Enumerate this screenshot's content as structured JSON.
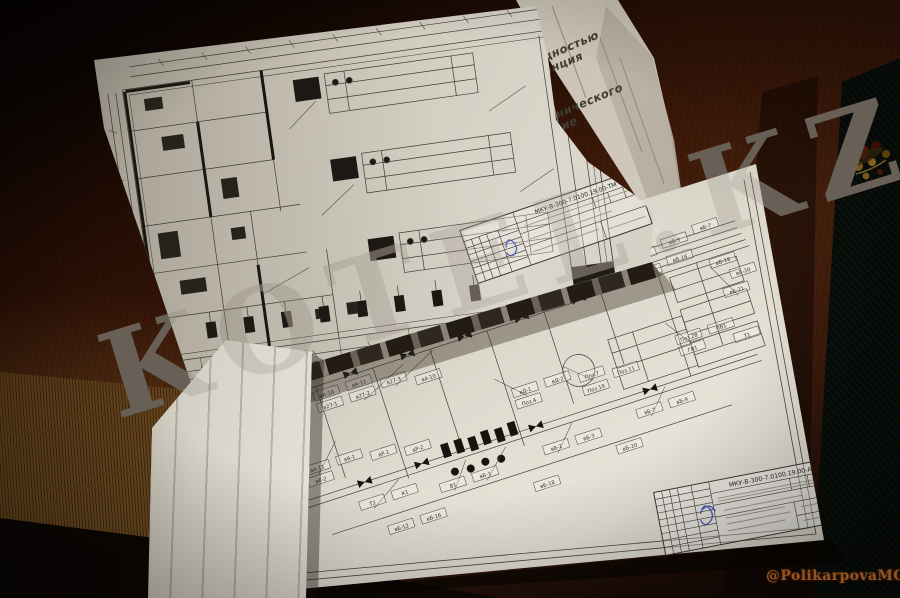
{
  "photo": {
    "watermark_text": "KOTEL.KZ",
    "attribution": "@PolikarpovaMG2020"
  },
  "album": {
    "page_edge_labels": [
      {
        "line1": "щностью",
        "line2": "танция"
      },
      {
        "line1": "нического",
        "line2": "ние"
      }
    ],
    "title_block_code": "МКУ-В-300-7.0100.19.00-ТМ"
  },
  "sheet": {
    "title_block_code": "МКУ-В-300-7.0100.19.00-АТМ",
    "tags": [
      "вБ-1",
      "вБ-2",
      "вБ-3",
      "вБ-7",
      "вБ-9",
      "вБ-12",
      "вБ-16",
      "вБ-18",
      "вБ-20",
      "вБ-21",
      "вК-10",
      "вК-11",
      "в27-1",
      "в27-2",
      "в27-3",
      "в4-10",
      "в4-11",
      "в6-1",
      "в6-2",
      "вР-1",
      "вР-2",
      "вД-1",
      "вД-2",
      "Поз.4",
      "Поз.7",
      "Поз.11",
      "Поз.19",
      "Поз.28",
      "ПВ1",
      "ГВ1",
      "Т1",
      "Т2",
      "К1",
      "В1"
    ]
  },
  "colors": {
    "stamp_blue": "#3f4cc0",
    "ornament_gold": "#a87a22",
    "watermark_gray": "#6e665c"
  }
}
